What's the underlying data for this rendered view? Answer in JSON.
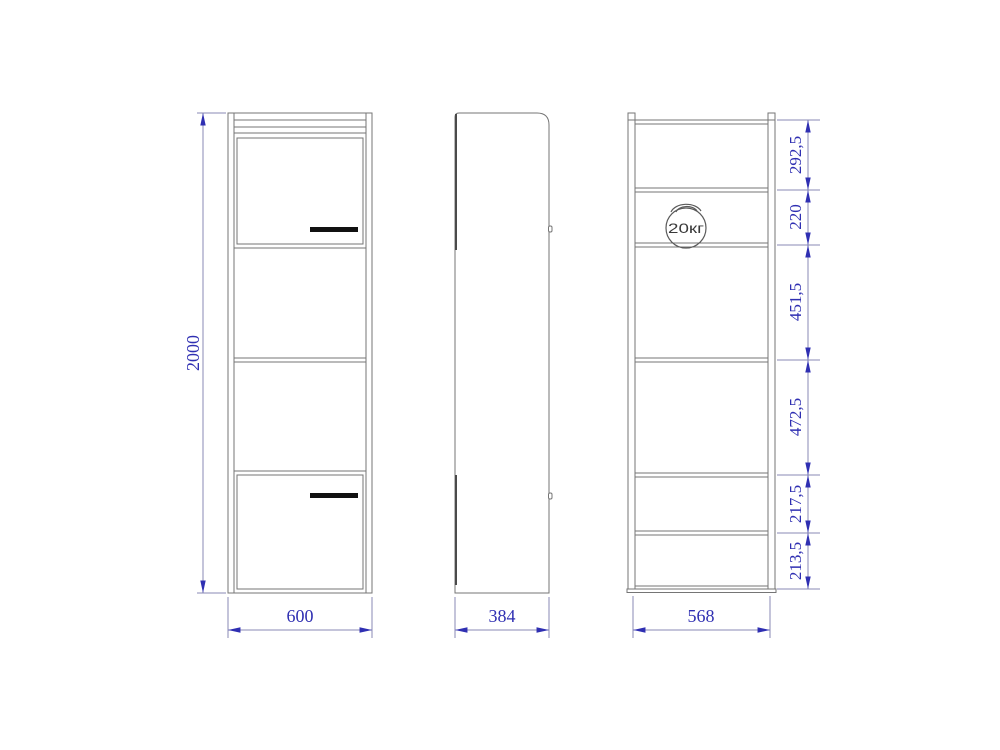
{
  "drawing": {
    "kind": "cabinet-three-view-technical-drawing",
    "views": {
      "front": {
        "height_dim": "2000",
        "width_dim": "600"
      },
      "side": {
        "depth_dim": "384"
      },
      "back": {
        "width_dim": "568",
        "section_dims": [
          "292,5",
          "220",
          "451,5",
          "472,5",
          "217,5",
          "213,5"
        ],
        "max_load": "20кг"
      }
    },
    "colors": {
      "outline": "#757575",
      "dimension_line": "#8888b4",
      "dimension_text": "#2f2fb2",
      "handle": "#111111",
      "background": "#ffffff"
    }
  }
}
